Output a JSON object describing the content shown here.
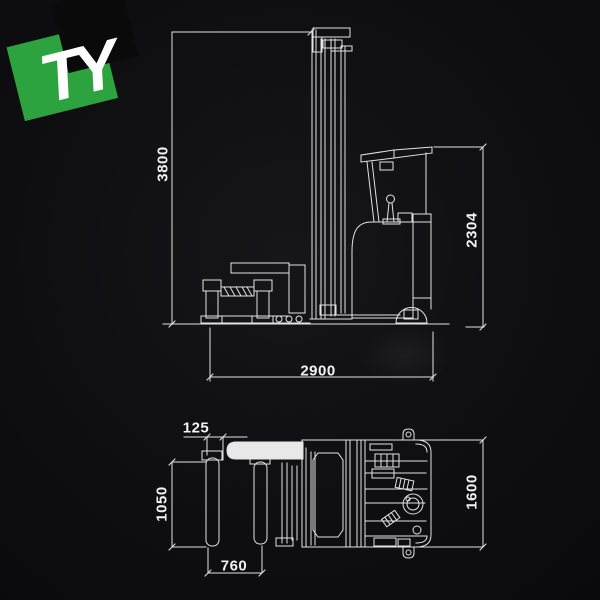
{
  "logo": {
    "text": "TY",
    "colors": {
      "green": "#2ca33e",
      "black": "#0a0a0a",
      "letters": "#ffffff"
    }
  },
  "canvas": {
    "background": "#101013",
    "line_color": "#e3e3e3",
    "label_color": "#f2f2f2"
  },
  "side_view": {
    "dimensions": [
      {
        "name": "mast-height",
        "label": "3800",
        "orientation": "vertical"
      },
      {
        "name": "overall-height",
        "label": "2304",
        "orientation": "vertical"
      },
      {
        "name": "overall-length",
        "label": "2900",
        "orientation": "horizontal"
      }
    ]
  },
  "top_view": {
    "dimensions": [
      {
        "name": "pad-offset",
        "label": "125",
        "orientation": "horizontal"
      },
      {
        "name": "pad-length",
        "label": "1050",
        "orientation": "vertical"
      },
      {
        "name": "pad-spread",
        "label": "760",
        "orientation": "horizontal"
      },
      {
        "name": "overall-width",
        "label": "1600",
        "orientation": "vertical"
      }
    ]
  }
}
